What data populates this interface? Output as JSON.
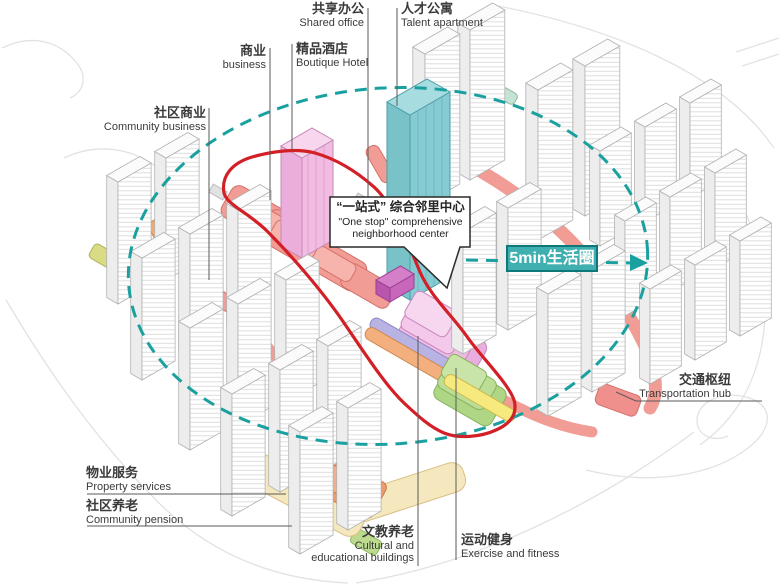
{
  "page": {
    "width": 780,
    "height": 585
  },
  "labels": {
    "shared_office": {
      "zh": "共享办公",
      "en": "Shared office"
    },
    "talent_apartment": {
      "zh": "人才公寓",
      "en": "Talent apartment"
    },
    "business": {
      "zh": "商业",
      "en": "business"
    },
    "boutique_hotel": {
      "zh": "精品酒店",
      "en": "Boutique Hotel"
    },
    "community_business": {
      "zh": "社区商业",
      "en": "Community business"
    },
    "property_services": {
      "zh": "物业服务",
      "en": "Property services"
    },
    "community_pension": {
      "zh": "社区养老",
      "en": "Community pension"
    },
    "cultural": {
      "zh": "文教养老",
      "en_line1": "Cultural and",
      "en_line2": "educational buildings"
    },
    "exercise": {
      "zh": "运动健身",
      "en": "Exercise and fitness"
    },
    "transportation_hub": {
      "zh": "交通枢纽",
      "en": "Transportation hub"
    }
  },
  "callout": {
    "zh": "“一站式” 综合邻里中心",
    "en_line1": "\"One stop\" comprehensive",
    "en_line2": "neighborhood center"
  },
  "badge": {
    "label": "5min生活圈"
  },
  "colors": {
    "circle_teal": "#1BA0A0",
    "badge_teal": "#3FAFAF",
    "loop_red": "#D31F26",
    "podium_salmon": "#F19C94",
    "office_teal": "#85CBD1",
    "hotel_pink": "#F2BCE2",
    "zig_pink": "#EFBCE4",
    "zig_green": "#BCDD95",
    "band_lavender": "#B9B3E3",
    "band_orange": "#F3B07E",
    "band_yellow": "#F6E97E",
    "podium_cream": "#F5E8BE",
    "block_orange": "#EC9A70",
    "block_magenta": "#C766BA"
  }
}
